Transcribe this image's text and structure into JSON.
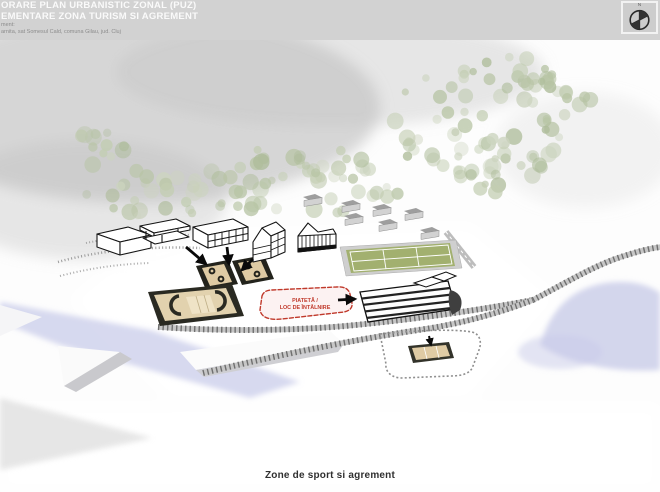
{
  "header": {
    "title_line1": "ORARE PLAN URBANISTIC ZONAL (PUZ)",
    "title_line2": "EMENTARE ZONA TURISM SI AGREMENT",
    "meta_line1": "ment:",
    "meta_line2": "arnita, sat Somesul Cald, comuna Gilau, jud. Cluj"
  },
  "compass": {
    "label": "N"
  },
  "plan": {
    "piateta_line1": "PIATETĂ /",
    "piateta_line2": "LOC DE ÎNTÂLNIRE"
  },
  "caption": "Zone de sport si agrement",
  "colors": {
    "header_bg": "#d2d2d2",
    "accent_red": "#c0392b",
    "tree_green": "#c2cdb1",
    "river_blue": "#c9cce9",
    "road_gray": "#c6c6c6",
    "court_tan": "#dfcba4",
    "tennis_green": "#a2b06f"
  }
}
